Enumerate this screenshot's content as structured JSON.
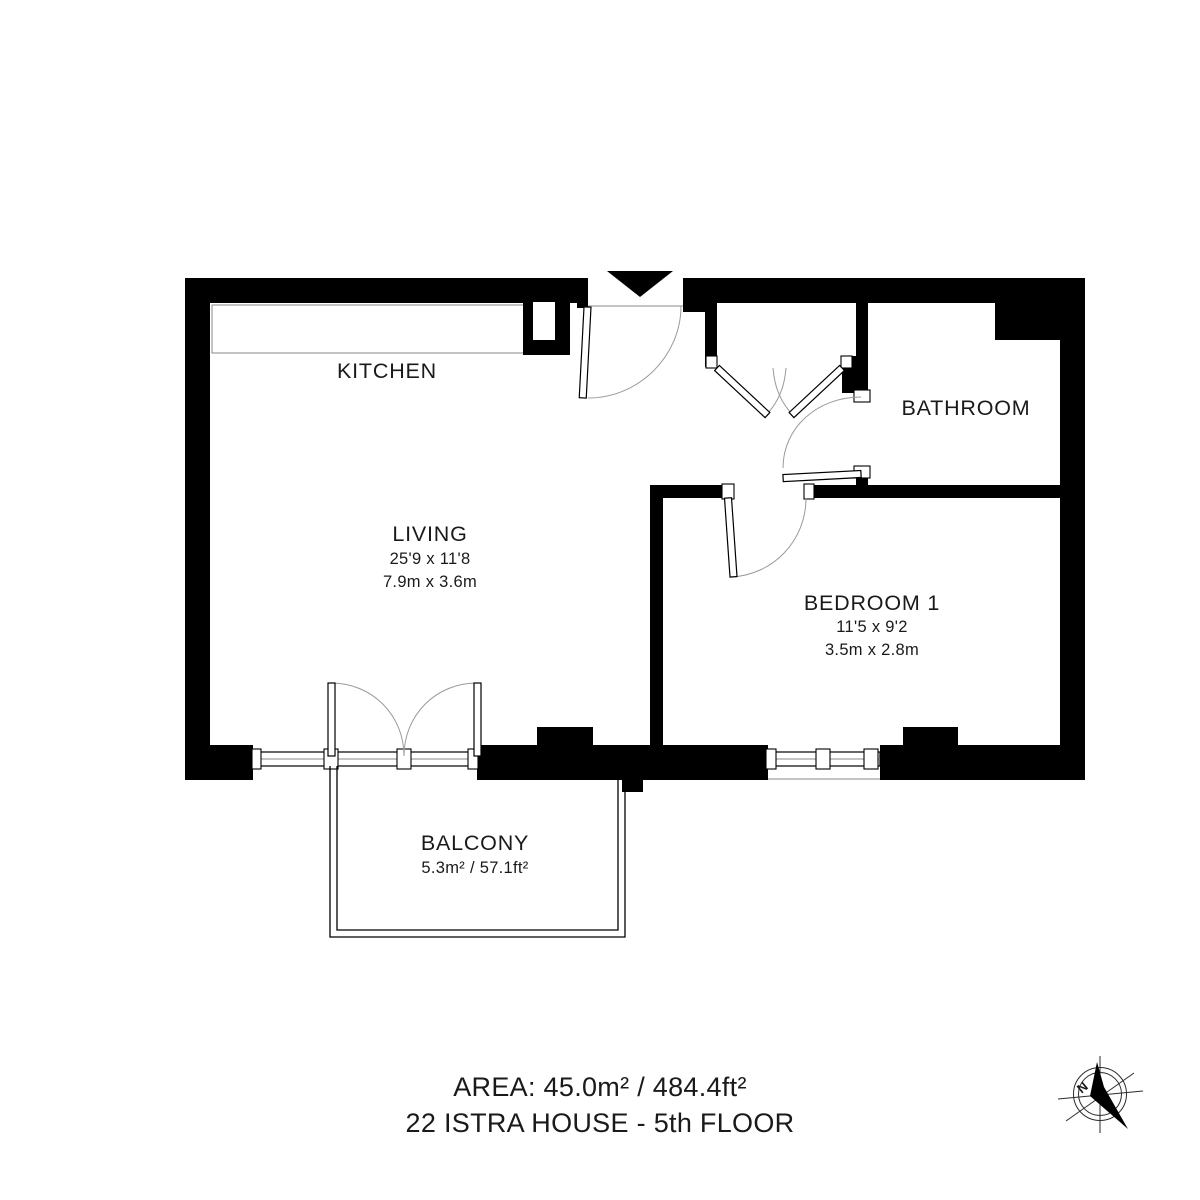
{
  "page": {
    "background_color": "#ffffff",
    "wall_color": "#000000",
    "door_arc_color": "#9a9a9a"
  },
  "rooms": {
    "kitchen": {
      "label": "KITCHEN"
    },
    "living": {
      "label": "LIVING",
      "dimensions_imperial": "25'9 x 11'8",
      "dimensions_metric": "7.9m x 3.6m"
    },
    "bathroom": {
      "label": "BATHROOM"
    },
    "bedroom1": {
      "label": "BEDROOM 1",
      "dimensions_imperial": "11'5 x 9'2",
      "dimensions_metric": "3.5m x 2.8m"
    },
    "balcony": {
      "label": "BALCONY",
      "area": "5.3m² / 57.1ft²"
    }
  },
  "footer": {
    "area_line": "AREA: 45.0m² / 484.4ft²",
    "address_line": "22 ISTRA HOUSE - 5th FLOOR"
  },
  "compass": {
    "north_label": "N"
  }
}
